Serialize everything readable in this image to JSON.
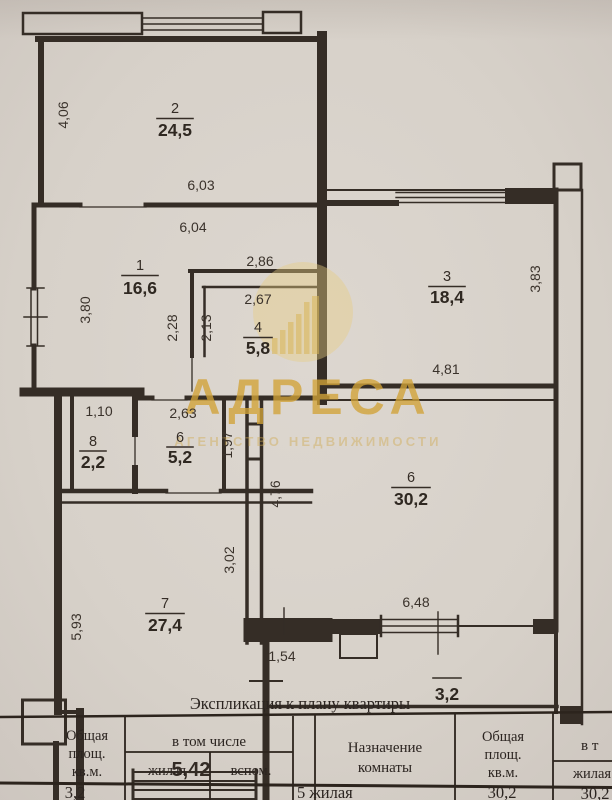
{
  "colors": {
    "watermark_gold": "#d2a338",
    "ink": "#352d26",
    "paper": "#d8d2ca"
  },
  "watermark": {
    "brand": "АДРЕСА",
    "subtitle": "АГЕНТСТВО НЕДВИЖИМОСТИ"
  },
  "plan": {
    "rooms": [
      {
        "number": "2",
        "area": "24,5"
      },
      {
        "number": "1",
        "area": "16,6"
      },
      {
        "number": "3",
        "area": "18,4"
      },
      {
        "number": "4",
        "area": "5,8"
      },
      {
        "number": "8",
        "area": "2,2"
      },
      {
        "number": "6",
        "area": "5,2"
      },
      {
        "number": "6",
        "area": "30,2"
      },
      {
        "number": "7",
        "area": "27,4"
      },
      {
        "number": "",
        "area": "3,2"
      }
    ],
    "dimensions": [
      "4,06",
      "6,03",
      "6,04",
      "2,86",
      "2,67",
      "3,80",
      "2,28",
      "2,13",
      "3,83",
      "4,81",
      "1,10",
      "2,63",
      "1,97",
      "4,76",
      "3,02",
      "5,93",
      "6,48",
      "1,54",
      "5,42"
    ]
  },
  "table": {
    "title": "Экспликация к плану квартиры",
    "col_total": {
      "l1": "Общая",
      "l2": "площ.",
      "l3": "кв.м."
    },
    "col_including": "в том числе",
    "col_living": "жилая",
    "col_aux": "вспом.",
    "col_purpose": {
      "l1": "Назначение",
      "l2": "комнаты"
    },
    "col_total2": {
      "l1": "Общая",
      "l2": "площ.",
      "l3": "кв.м."
    },
    "col_including2": "в т",
    "col_living2": "жилая",
    "row": {
      "total": "3,2",
      "purpose": "5 жилая",
      "total2": "30,2",
      "living2": "30,2"
    }
  }
}
